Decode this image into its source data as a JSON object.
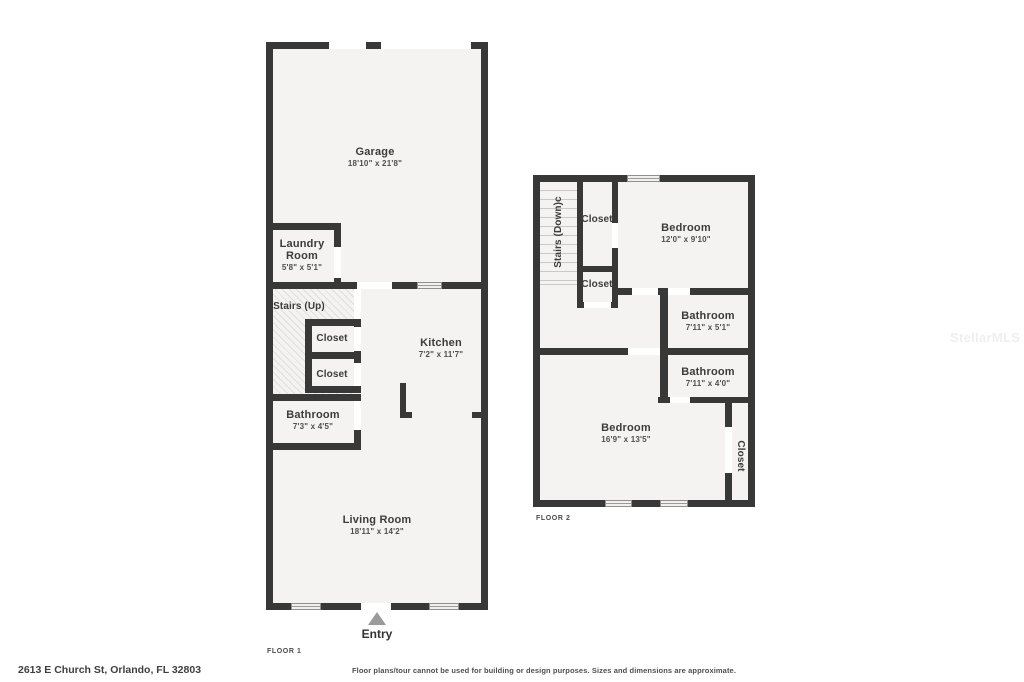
{
  "watermark": "StellarMLS",
  "floor1": {
    "tag": "FLOOR 1",
    "entry": "Entry",
    "rooms": {
      "garage": {
        "name": "Garage",
        "dims": "18'10\" x 21'8\""
      },
      "laundry": {
        "name": "Laundry Room",
        "dims": "5'8\" x 5'1\""
      },
      "stairs": {
        "name": "Stairs (Up)"
      },
      "closet_a": {
        "name": "Closet"
      },
      "closet_b": {
        "name": "Closet"
      },
      "bathroom": {
        "name": "Bathroom",
        "dims": "7'3\" x 4'5\""
      },
      "kitchen": {
        "name": "Kitchen",
        "dims": "7'2\" x 11'7\""
      },
      "living_room": {
        "name": "Living Room",
        "dims": "18'11\" x 14'2\""
      }
    }
  },
  "floor2": {
    "tag": "FLOOR 2",
    "rooms": {
      "stairs": {
        "name": "Stairs (Down)c"
      },
      "closet_a": {
        "name": "Closet"
      },
      "closet_b": {
        "name": "Closet"
      },
      "bedroom_a": {
        "name": "Bedroom",
        "dims": "12'0\" x 9'10\""
      },
      "bathroom_a": {
        "name": "Bathroom",
        "dims": "7'11\" x 5'1\""
      },
      "bathroom_b": {
        "name": "Bathroom",
        "dims": "7'11\" x 4'0\""
      },
      "bedroom_b": {
        "name": "Bedroom",
        "dims": "16'9\" x 13'5\""
      },
      "closet_c": {
        "name": "Closet"
      }
    }
  },
  "footer": {
    "address": "2613 E Church St, Orlando, FL 32803",
    "disclaimer": "Floor plans/tour cannot be used for building or design purposes. Sizes and dimensions are approximate."
  }
}
